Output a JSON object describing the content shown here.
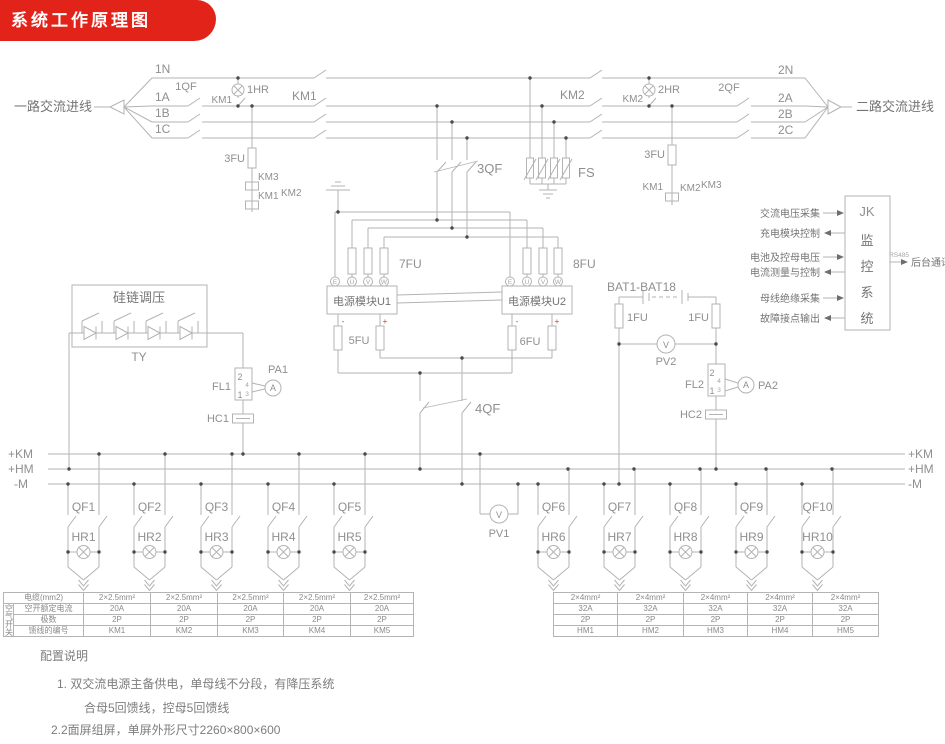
{
  "banner": {
    "title": "系统工作原理图"
  },
  "colors": {
    "banner_red": "#e2231a",
    "line_gray": "#b3b3b3",
    "label_gray": "#8a8a8a"
  },
  "incoming": {
    "left_label": "一路交流进线",
    "right_label": "二路交流进线",
    "left_lines": [
      "1N",
      "1A",
      "1B",
      "1C"
    ],
    "right_lines": [
      "2N",
      "2A",
      "2B",
      "2C"
    ]
  },
  "top": {
    "qf1": "1QF",
    "km1_aux": "KM1",
    "hr1": "1HR",
    "km1_main": "KM1",
    "km2_main": "KM2",
    "km2_aux": "KM2",
    "hr2": "2HR",
    "qf2": "2QF",
    "qf3": "3QF",
    "fs": "FS",
    "fu3_left": "3FU",
    "left_km3": "KM3",
    "left_km1": "KM1",
    "left_km2": "KM2",
    "fu3_right": "3FU",
    "right_km1": "KM1",
    "right_km2": "KM2",
    "right_km3": "KM3"
  },
  "modules": {
    "u1": "电源模块U1",
    "u2": "电源模块U2",
    "fu7": "7FU",
    "fu8": "8FU",
    "fu5": "5FU",
    "fu6": "6FU",
    "terminals": [
      "E",
      "U",
      "V",
      "W"
    ],
    "minus": "-",
    "plus": "+"
  },
  "regulator": {
    "title": "硅链调压",
    "tag": "TY"
  },
  "dc": {
    "fl1": "FL1",
    "pa1": "PA1",
    "hc1": "HC1",
    "qf4": "4QF",
    "battery": "BAT1-BAT18",
    "fu1_left": "1FU",
    "fu1_right": "1FU",
    "pv2": "PV2",
    "fl2": "FL2",
    "pa2": "PA2",
    "hc2": "HC2",
    "pv1": "PV1",
    "t2": "2",
    "t4": "4",
    "t3": "3",
    "t1": "1",
    "meter_a": "A",
    "meter_v": "V"
  },
  "buses": {
    "left": [
      "+KM",
      "+HM",
      "-M"
    ],
    "right": [
      "+KM",
      "+HM",
      "-M"
    ]
  },
  "monitor": {
    "box": [
      "JK",
      "监",
      "控",
      "系",
      "统"
    ],
    "signals": [
      {
        "label": "交流电压采集",
        "dir": "in"
      },
      {
        "label": "充电模块控制",
        "dir": "out"
      },
      {
        "label": "电池及控母电压",
        "dir": "in"
      },
      {
        "label": "电流测量与控制",
        "dir": "out"
      },
      {
        "label": "母线绝缘采集",
        "dir": "in"
      },
      {
        "label": "故障接点输出",
        "dir": "out"
      }
    ],
    "comm_label": "后台通讯",
    "comm_protocol": "RS485"
  },
  "feeders": {
    "km": [
      {
        "qf": "QF1",
        "hr": "HR1"
      },
      {
        "qf": "QF2",
        "hr": "HR2"
      },
      {
        "qf": "QF3",
        "hr": "HR3"
      },
      {
        "qf": "QF4",
        "hr": "HR4"
      },
      {
        "qf": "QF5",
        "hr": "HR5"
      }
    ],
    "hm": [
      {
        "qf": "QF6",
        "hr": "HR6"
      },
      {
        "qf": "QF7",
        "hr": "HR7"
      },
      {
        "qf": "QF8",
        "hr": "HR8"
      },
      {
        "qf": "QF9",
        "hr": "HR9"
      },
      {
        "qf": "QF10",
        "hr": "HR10"
      }
    ]
  },
  "tables": {
    "km": {
      "side_label": "空气开关",
      "row_headers": [
        "电缆(mm2)",
        "空开额定电流",
        "极数",
        "馈线的编号"
      ],
      "rows": [
        [
          "2×2.5mm²",
          "2×2.5mm²",
          "2×2.5mm²",
          "2×2.5mm²",
          "2×2.5mm²"
        ],
        [
          "20A",
          "20A",
          "20A",
          "20A",
          "20A"
        ],
        [
          "2P",
          "2P",
          "2P",
          "2P",
          "2P"
        ],
        [
          "KM1",
          "KM2",
          "KM3",
          "KM4",
          "KM5"
        ]
      ]
    },
    "hm": {
      "rows": [
        [
          "2×4mm²",
          "2×4mm²",
          "2×4mm²",
          "2×4mm²",
          "2×4mm²"
        ],
        [
          "32A",
          "32A",
          "32A",
          "32A",
          "32A"
        ],
        [
          "2P",
          "2P",
          "2P",
          "2P",
          "2P"
        ],
        [
          "HM1",
          "HM2",
          "HM3",
          "HM4",
          "HM5"
        ]
      ]
    }
  },
  "notes": {
    "title": "配置说明",
    "line1": "1. 双交流电源主备供电，单母线不分段，有降压系统",
    "line2": "合母5回馈线，控母5回馈线",
    "line3": "2.2面屏组屏，单屏外形尺寸2260×800×600"
  }
}
